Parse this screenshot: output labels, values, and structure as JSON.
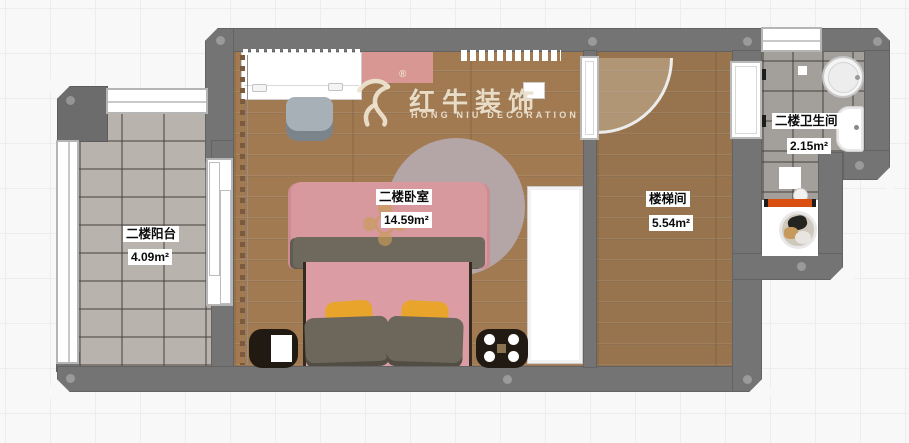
{
  "watermark": {
    "brand": "红牛装饰",
    "subtitle": "HONG NIU DECORATION",
    "registered": "®",
    "icon": "bull-icon",
    "color": "#e9dfcb"
  },
  "rooms": {
    "balcony": {
      "name": "二楼阳台",
      "area": "4.09m²"
    },
    "bedroom": {
      "name": "二楼卧室",
      "area": "14.59m²"
    },
    "stairwell": {
      "name": "楼梯间",
      "area": "5.54m²"
    },
    "bathroom": {
      "name": "二楼卫生间",
      "area": "2.15m²"
    }
  },
  "colors": {
    "wall": "#747474",
    "wood_floor": "#a17a52",
    "stairwell_floor": "#97744e",
    "balcony_tile": "#b8b3ad",
    "bathroom_tile": "#a39f9b",
    "bed_pink": "#db9da3",
    "blanket_gray": "#6f695d",
    "pillow_yellow": "#e9a42c",
    "washer_accent_orange": "#d94f10",
    "watermark_cream": "#e9dfcb"
  },
  "icons": {
    "bed": "double-bed-top-view",
    "rug": "round-rug",
    "wardrobe": "wardrobe",
    "desk": "desk",
    "chair": "chair",
    "basin": "round-washbasin",
    "toilet": "toilet",
    "washing_machine": "washing-machine",
    "door": "door-swing-arc",
    "window": "window"
  }
}
